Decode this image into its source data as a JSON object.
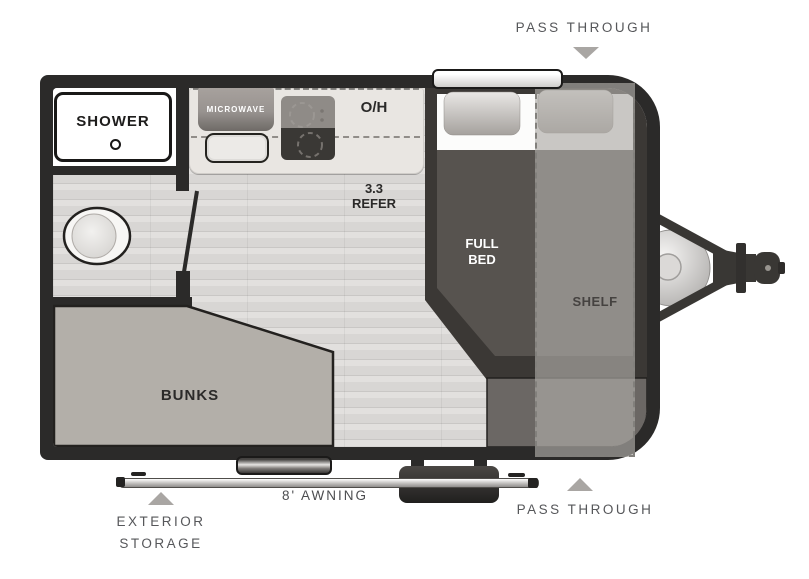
{
  "title": "Travel trailer floorplan",
  "callouts": {
    "pass_through_top": "PASS THROUGH",
    "pass_through_bottom": "PASS THROUGH",
    "exterior_storage_line1": "EXTERIOR",
    "exterior_storage_line2": "STORAGE",
    "awning": "8' AWNING"
  },
  "interior": {
    "shower": "SHOWER",
    "microwave": "MICROWAVE",
    "overhead": "O/H",
    "refer_line1": "3.3",
    "refer_line2": "REFER",
    "full_bed_line1": "FULL",
    "full_bed_line2": "BED",
    "shelf": "SHELF",
    "bunks": "BUNKS"
  },
  "colors": {
    "wall": "#2b2a29",
    "floor": "#dcdad8",
    "counter": "#e9e6e2",
    "bunks_fill": "#b3afa9",
    "bed_base": "#3b3835",
    "bed_blanket": "#57534f",
    "bed_foot_box": "#6b6764",
    "shelf_overlay": "#aeaaa6",
    "callout_text": "#56575a",
    "arrow": "#a9a6a3"
  }
}
